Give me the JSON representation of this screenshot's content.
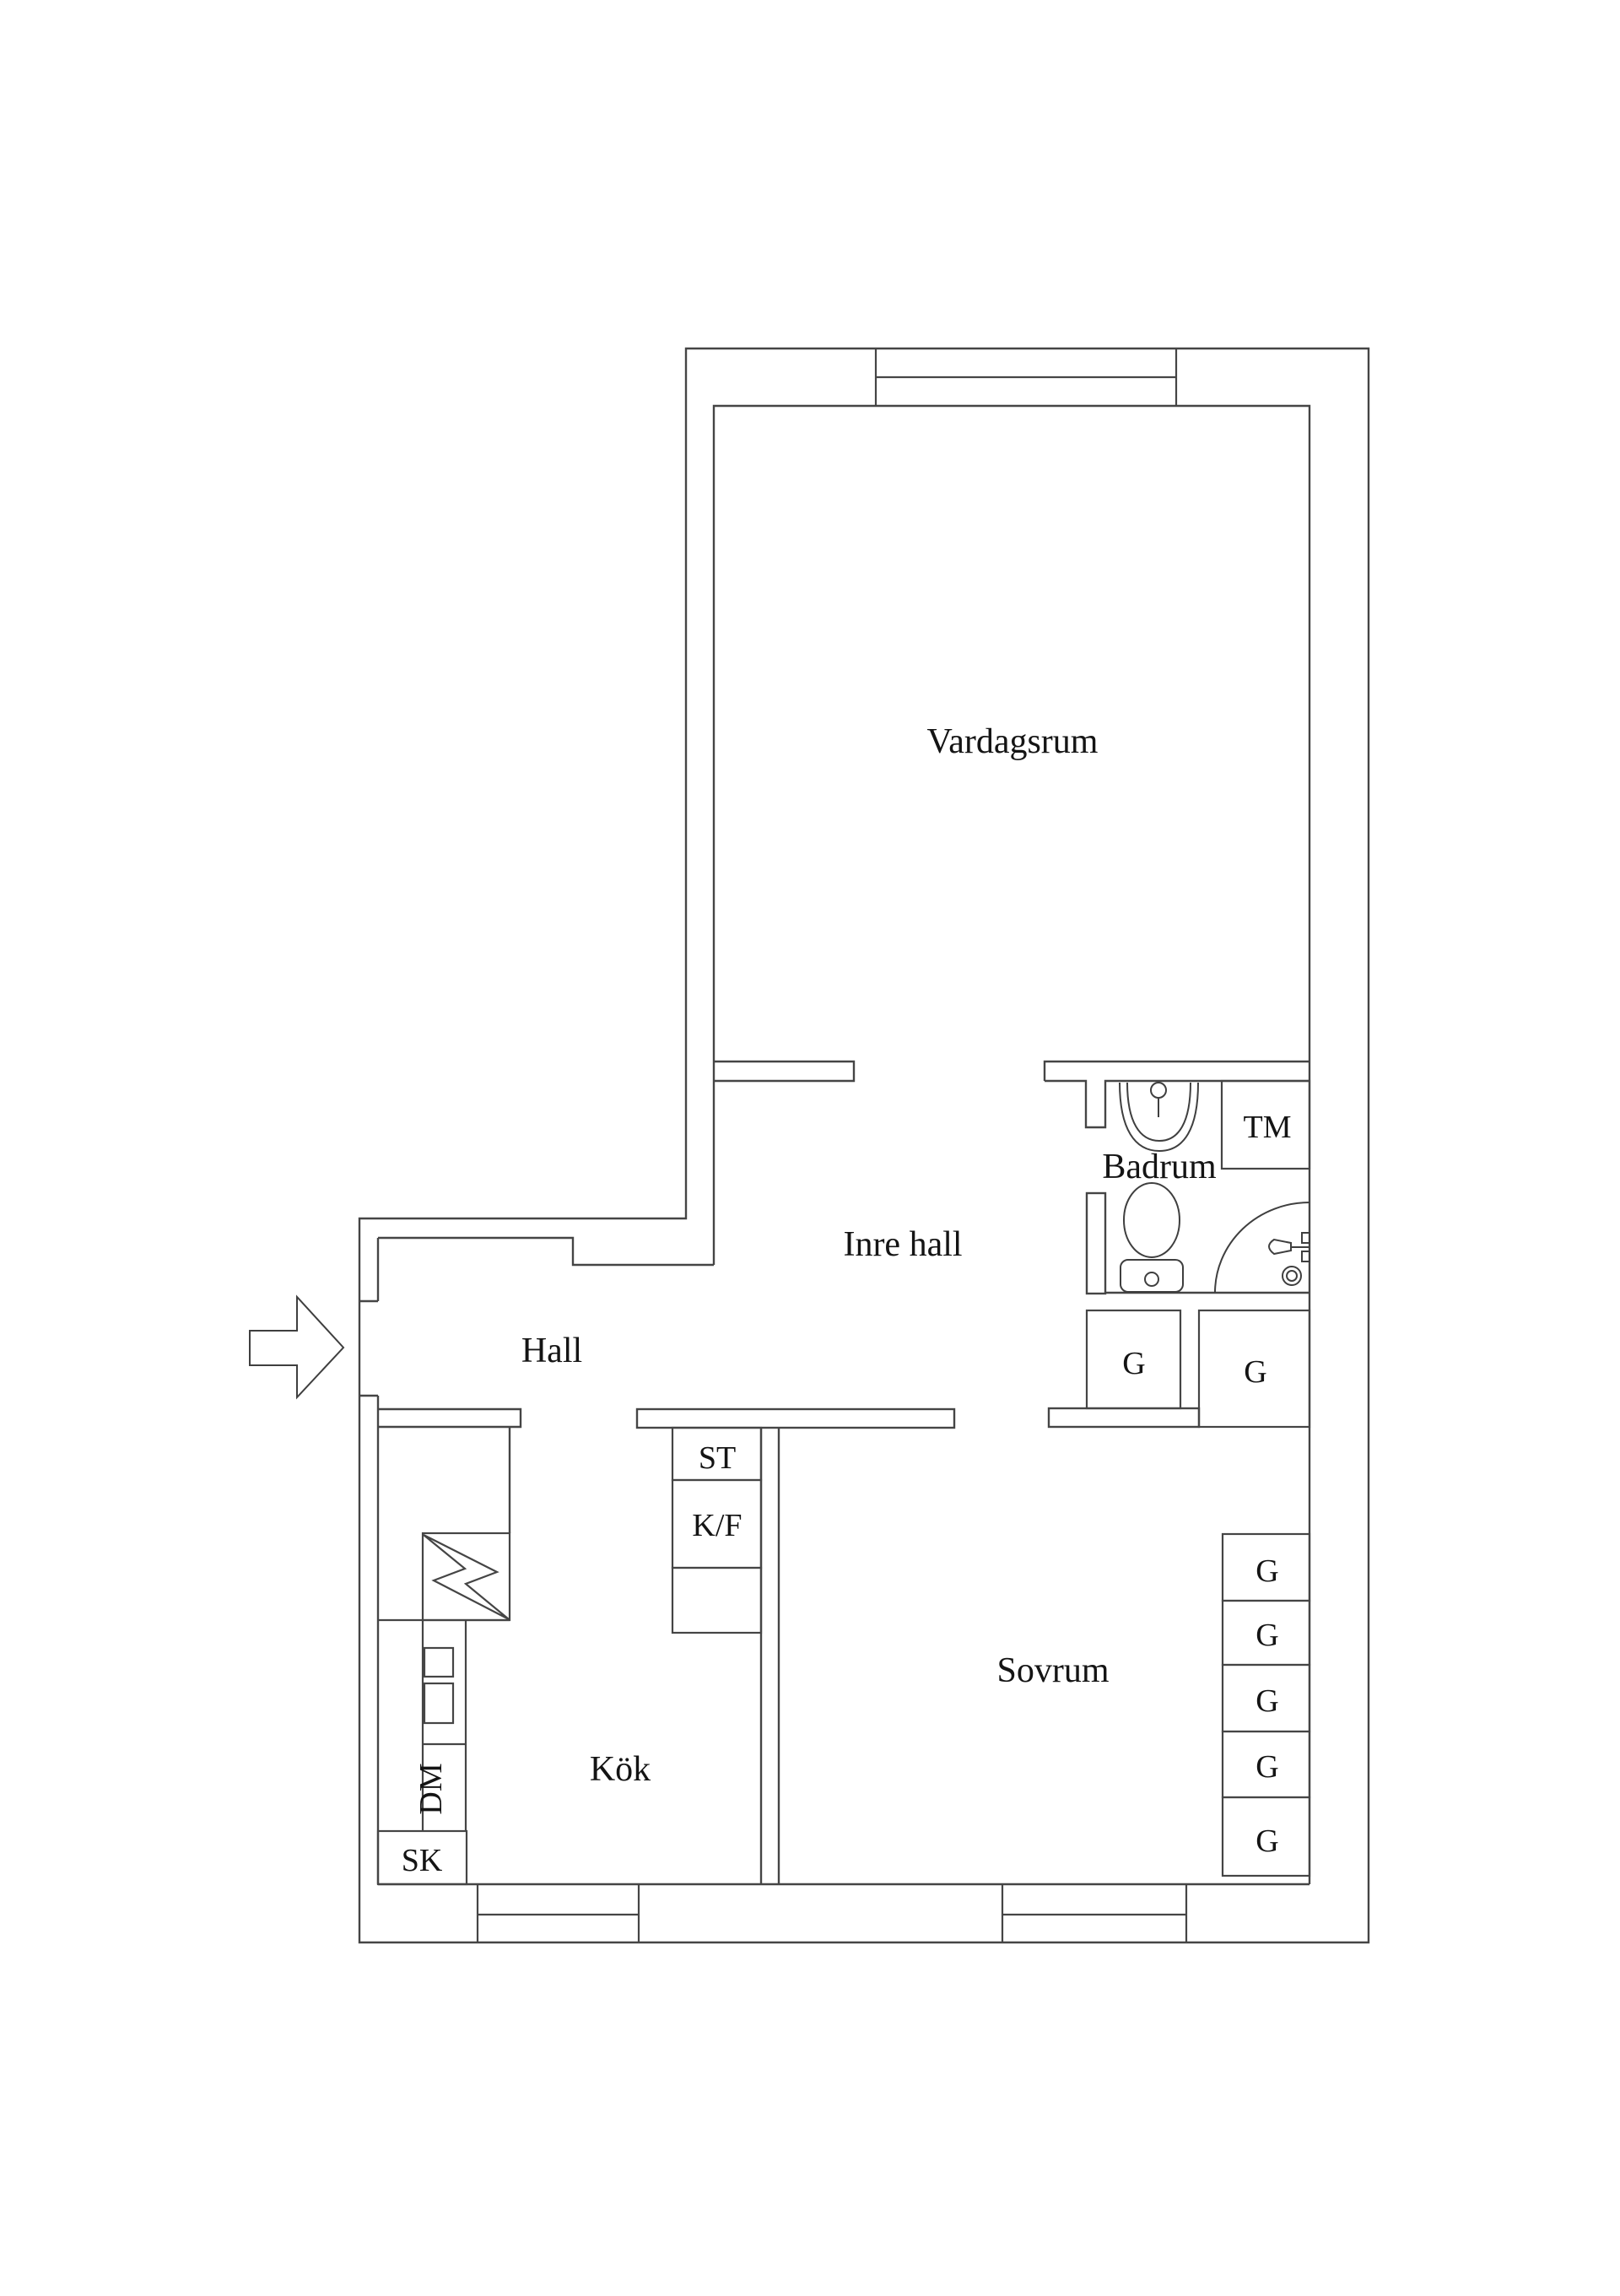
{
  "plan": {
    "type": "apartment-floor-plan",
    "style": "black-line drawing on white",
    "colors": {
      "background": "#ffffff",
      "walls": "#454545",
      "text": "#141414"
    },
    "rooms": [
      {
        "key": "vardagsrum",
        "label": "Vardagsrum"
      },
      {
        "key": "inre_hall",
        "label": "Inre hall"
      },
      {
        "key": "hall",
        "label": "Hall"
      },
      {
        "key": "badrum",
        "label": "Badrum"
      },
      {
        "key": "sovrum",
        "label": "Sovrum"
      },
      {
        "key": "kok",
        "label": "Kök"
      }
    ],
    "labels": {
      "vardagsrum": "Vardagsrum",
      "inre_hall": "Inre hall",
      "hall": "Hall",
      "badrum": "Badrum",
      "sovrum": "Sovrum",
      "kok": "Kök",
      "tm": "TM",
      "st": "ST",
      "kf": "K/F",
      "dm": "DM",
      "sk": "SK",
      "g": "G"
    },
    "counts": {
      "wardrobe_g_boxes": 7,
      "windows": 3,
      "entrance_arrows": 1
    }
  }
}
